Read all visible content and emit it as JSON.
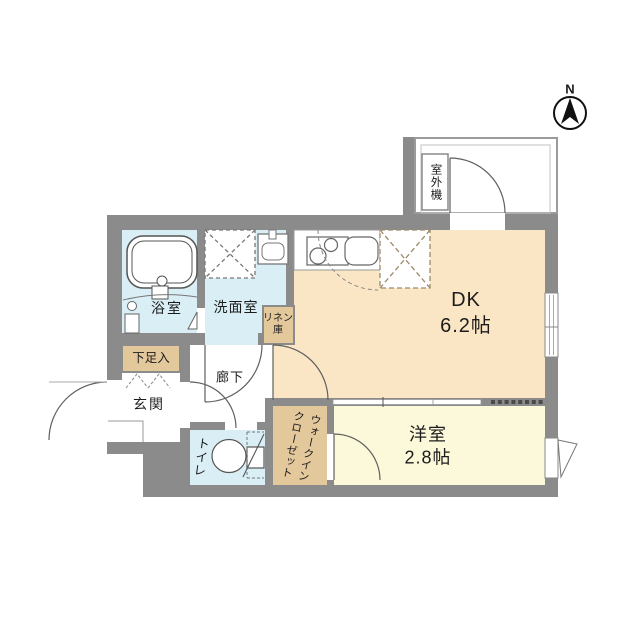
{
  "compass": {
    "label": "N"
  },
  "rooms": {
    "dk": {
      "label": "DK",
      "area": "6.2帖"
    },
    "youshitsu": {
      "label": "洋室",
      "area": "2.8帖"
    },
    "bathroom": {
      "label": "浴室"
    },
    "washroom": {
      "label": "洗面室"
    },
    "entrance": {
      "label": "玄関"
    },
    "hallway": {
      "label": "廊下"
    },
    "toilet": {
      "label": "トイレ"
    },
    "wic": {
      "line1": "ウォークイン",
      "line2": "クローゼット"
    },
    "shoe_box": {
      "label": "下足入"
    },
    "linen": {
      "line1": "リネン",
      "line2": "庫"
    },
    "outdoor_unit": {
      "label": "室外機"
    }
  },
  "colors": {
    "wall": "#8b8b8b",
    "dk_floor": "#fae6c4",
    "western_floor": "#fcf9da",
    "wet_floor": "#daeef5",
    "storage": "#e3c89c"
  }
}
